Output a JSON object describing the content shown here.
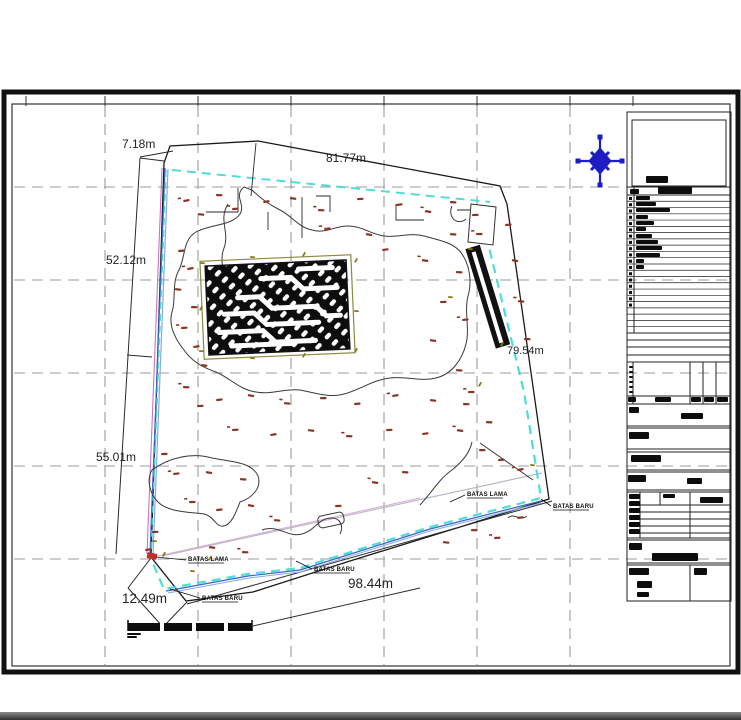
{
  "dim_labels": {
    "top_small": "7.18m",
    "top": "81.77m",
    "left_upper": "52.12m",
    "left_lower": "55.01m",
    "bottom_left": "12.49m",
    "bottom": "98.44m",
    "right": "79.54m"
  },
  "boundary_labels": {
    "lama1": "BATAS LAMA",
    "baru1": "BATAS BARU",
    "lama2": "BATAS LAMA",
    "baru2": "BATAS BARU",
    "baru3": "BATAS BARU"
  },
  "colors": {
    "boundary_new_cyan": "#3cd9d2",
    "boundary_blue": "#3a63c4",
    "boundary_blue_light": "#86aadf",
    "boundary_old_magenta": "#c973c9",
    "old_line_gray": "#b9b9c6",
    "old_line_pink": "#d9a9d2",
    "compass_blue": "#1c1cc4",
    "survey_mark": "#8a3424",
    "tick_olive": "#8a7a10",
    "grid_gray": "#9b9b9b",
    "corner_red": "#c03028",
    "bar_black": "#0d0d0d"
  },
  "grid": {
    "vx": [
      105,
      198,
      291,
      384,
      477,
      570
    ],
    "hy": [
      187,
      280,
      373,
      466,
      559
    ],
    "ticks_top": [
      26,
      105,
      198,
      291,
      384,
      477,
      570,
      633
    ]
  },
  "survey_points": [
    [
      183,
      200
    ],
    [
      198,
      213
    ],
    [
      216,
      194
    ],
    [
      232,
      208
    ],
    [
      263,
      201
    ],
    [
      290,
      197
    ],
    [
      318,
      209
    ],
    [
      357,
      198
    ],
    [
      396,
      204
    ],
    [
      425,
      210
    ],
    [
      450,
      201
    ],
    [
      472,
      214
    ],
    [
      324,
      228
    ],
    [
      366,
      233
    ],
    [
      450,
      233
    ],
    [
      476,
      233
    ],
    [
      505,
      224
    ],
    [
      512,
      259
    ],
    [
      518,
      300
    ],
    [
      524,
      338
    ],
    [
      178,
      250
    ],
    [
      187,
      268
    ],
    [
      175,
      288
    ],
    [
      191,
      306
    ],
    [
      181,
      327
    ],
    [
      193,
      346
    ],
    [
      201,
      364
    ],
    [
      183,
      386
    ],
    [
      197,
      405
    ],
    [
      382,
      249
    ],
    [
      422,
      259
    ],
    [
      456,
      271
    ],
    [
      440,
      301
    ],
    [
      462,
      319
    ],
    [
      430,
      339
    ],
    [
      456,
      369
    ],
    [
      468,
      391
    ],
    [
      216,
      399
    ],
    [
      248,
      394
    ],
    [
      284,
      402
    ],
    [
      320,
      397
    ],
    [
      354,
      403
    ],
    [
      392,
      395
    ],
    [
      430,
      399
    ],
    [
      463,
      403
    ],
    [
      232,
      429
    ],
    [
      270,
      434
    ],
    [
      308,
      429
    ],
    [
      346,
      435
    ],
    [
      386,
      429
    ],
    [
      422,
      433
    ],
    [
      457,
      429
    ],
    [
      486,
      421
    ],
    [
      161,
      453
    ],
    [
      173,
      473
    ],
    [
      206,
      471
    ],
    [
      240,
      478
    ],
    [
      189,
      501
    ],
    [
      216,
      509
    ],
    [
      248,
      504
    ],
    [
      274,
      519
    ],
    [
      479,
      449
    ],
    [
      498,
      459
    ],
    [
      517,
      469
    ],
    [
      443,
      541
    ],
    [
      471,
      529
    ],
    [
      494,
      537
    ],
    [
      517,
      517
    ],
    [
      209,
      546
    ],
    [
      242,
      551
    ],
    [
      152,
      531
    ],
    [
      145,
      549
    ],
    [
      372,
      481
    ],
    [
      402,
      471
    ],
    [
      335,
      505
    ]
  ],
  "olive_ticks": [
    [
      200,
      262
    ],
    [
      199,
      310
    ],
    [
      199,
      350
    ],
    [
      354,
      262
    ],
    [
      354,
      310
    ],
    [
      354,
      352
    ],
    [
      250,
      256
    ],
    [
      302,
      256
    ],
    [
      250,
      357
    ],
    [
      302,
      357
    ],
    [
      468,
      248
    ],
    [
      500,
      346
    ],
    [
      448,
      296
    ],
    [
      478,
      386
    ],
    [
      152,
      540
    ],
    [
      162,
      556
    ],
    [
      190,
      570
    ],
    [
      208,
      560
    ],
    [
      530,
      464
    ]
  ],
  "titleblock": {
    "legend_row_count": 22,
    "legend_tick_count": 18,
    "bars": [
      [
        646,
        176,
        22,
        7
      ],
      [
        630,
        189,
        9,
        5
      ],
      [
        658,
        187,
        34,
        7
      ],
      [
        636,
        196,
        14,
        4
      ],
      [
        636,
        202,
        20,
        4
      ],
      [
        636,
        208,
        34,
        4
      ],
      [
        636,
        215,
        12,
        4
      ],
      [
        636,
        221,
        18,
        4
      ],
      [
        636,
        227,
        10,
        4
      ],
      [
        636,
        234,
        16,
        4
      ],
      [
        636,
        240,
        22,
        4
      ],
      [
        636,
        246,
        26,
        4
      ],
      [
        636,
        253,
        24,
        4
      ],
      [
        636,
        259,
        8,
        4
      ],
      [
        636,
        265,
        8,
        4
      ],
      [
        629,
        366,
        4,
        2
      ],
      [
        629,
        371,
        4,
        2
      ],
      [
        629,
        376,
        4,
        2
      ],
      [
        629,
        381,
        4,
        2
      ],
      [
        629,
        386,
        4,
        2
      ],
      [
        629,
        391,
        4,
        2
      ],
      [
        628,
        397,
        8,
        5
      ],
      [
        655,
        397,
        16,
        5
      ],
      [
        691,
        397,
        10,
        5
      ],
      [
        704,
        397,
        10,
        5
      ],
      [
        717,
        397,
        11,
        5
      ],
      [
        629,
        407,
        10,
        6
      ],
      [
        681,
        413,
        22,
        6
      ],
      [
        629,
        432,
        20,
        7
      ],
      [
        631,
        455,
        30,
        7
      ],
      [
        628,
        475,
        18,
        7
      ],
      [
        687,
        478,
        15,
        6
      ],
      [
        629,
        494,
        11,
        5
      ],
      [
        629,
        501,
        11,
        5
      ],
      [
        629,
        508,
        11,
        5
      ],
      [
        629,
        515,
        11,
        5
      ],
      [
        629,
        522,
        11,
        5
      ],
      [
        629,
        529,
        11,
        5
      ],
      [
        663,
        494,
        12,
        4
      ],
      [
        700,
        497,
        23,
        6
      ],
      [
        629,
        543,
        13,
        7
      ],
      [
        652,
        553,
        46,
        8
      ],
      [
        629,
        568,
        20,
        7
      ],
      [
        637,
        581,
        15,
        7
      ],
      [
        694,
        568,
        13,
        7
      ],
      [
        637,
        592,
        12,
        5
      ],
      [
        127,
        633,
        14,
        2
      ],
      [
        127,
        636,
        10,
        2
      ]
    ]
  }
}
